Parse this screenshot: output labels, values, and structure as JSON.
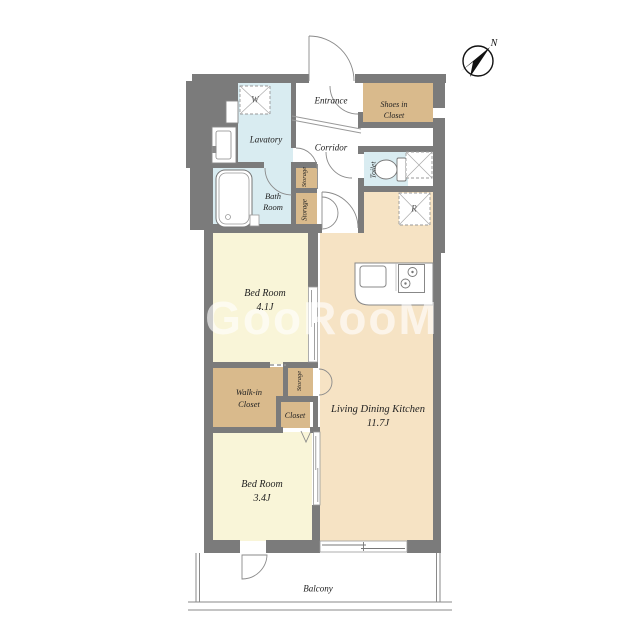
{
  "plan": {
    "watermark": "GooRooM",
    "compass": {
      "north_label": "N"
    },
    "labels": {
      "entrance": "Entrance",
      "shoes_in_closet_line1": "Shoes in",
      "shoes_in_closet_line2": "Closet",
      "lavatory": "Lavatory",
      "corridor": "Corridor",
      "toilet": "Toilet",
      "storage_upper": "Storage",
      "storage_lower": "Storage",
      "storage_wic": "Storage",
      "bath_line1": "Bath",
      "bath_line2": "Room",
      "bedroom1_name": "Bed Room",
      "bedroom1_size": "4.1J",
      "bedroom2_name": "Bed Room",
      "bedroom2_size": "3.4J",
      "ldk_name": "Living Dining Kitchen",
      "ldk_size": "11.7J",
      "walkin_line1": "Walk-in",
      "walkin_line2": "Closet",
      "closet": "Closet",
      "balcony": "Balcony",
      "washer_symbol": "W",
      "fridge_symbol": "R"
    },
    "colors": {
      "wall": "#7b7b7b",
      "bedroom_floor": "#f9f5d8",
      "ldk_floor": "#f6e3c4",
      "closet_floor": "#d9ba8c",
      "wet_area_floor": "#d9ecf1",
      "background": "#ffffff"
    }
  }
}
